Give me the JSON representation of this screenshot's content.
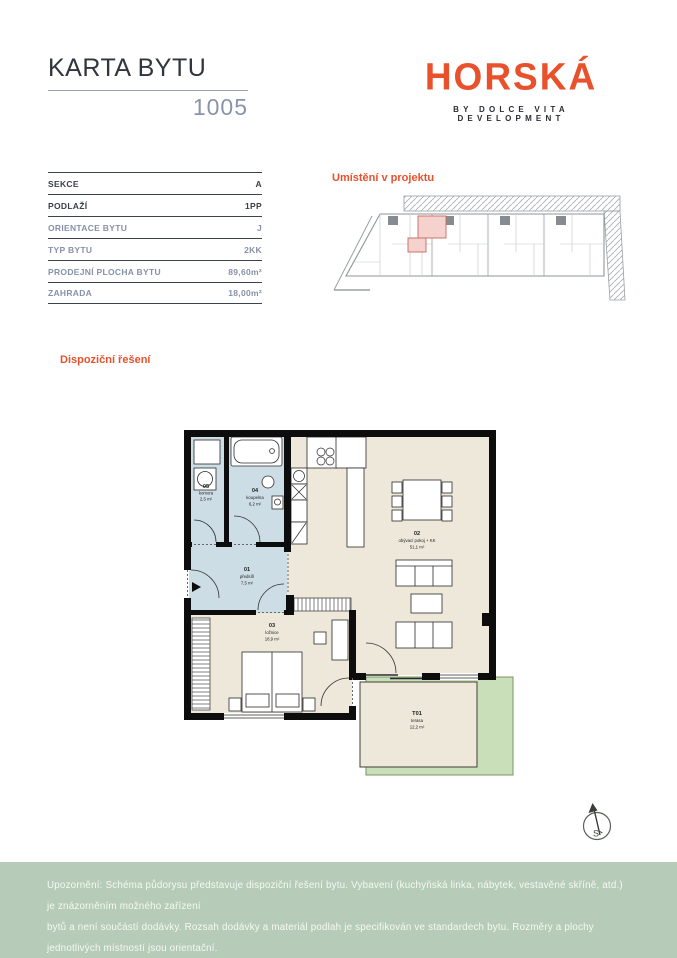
{
  "page": {
    "title": "KARTA BYTU",
    "unit_number": "1005"
  },
  "brand": {
    "logo_text": "HORSKÁ",
    "tagline": "BY DOLCE VITA DEVELOPMENT",
    "accent_color": "#e8512c"
  },
  "details_table": {
    "rows": [
      {
        "label": "SEKCE",
        "value": "A"
      },
      {
        "label": "PODLAŽÍ",
        "value": "1PP"
      },
      {
        "label": "ORIENTACE BYTU",
        "value": "J"
      },
      {
        "label": "TYP BYTU",
        "value": "2KK"
      },
      {
        "label": "PRODEJNÍ PLOCHA BYTU",
        "value": "89,60m²"
      },
      {
        "label": "ZAHRADA",
        "value": "18,00m²"
      }
    ]
  },
  "sections": {
    "location_heading": "Umístění v projektu",
    "layout_heading": "Dispoziční řešení"
  },
  "floor_plan": {
    "rooms": [
      {
        "id": "01",
        "name": "předsíň",
        "area": "7,5 m²"
      },
      {
        "id": "02",
        "name": "obývací pokoj + KK",
        "area": "51,1 m²"
      },
      {
        "id": "03",
        "name": "ložnice",
        "area": "18,9 m²"
      },
      {
        "id": "04",
        "name": "koupelna",
        "area": "6,2 m²"
      },
      {
        "id": "05",
        "name": "komora",
        "area": "2,5 m²"
      },
      {
        "id": "T01",
        "name": "terasa",
        "area": "12,2 m²"
      }
    ],
    "colors": {
      "room_blue": "#cddde6",
      "room_beige": "#ede8da",
      "garden_green": "#c8dfb9",
      "highlight_pink": "#f6d2ce"
    }
  },
  "compass": {
    "north_label": "S"
  },
  "footer": {
    "disclaimer_lines": [
      "Upozornění: Schéma půdorysu představuje dispoziční řešení bytu. Vybavení (kuchyňská linka, nábytek, vestavěné skříně, atd.) je znázorněním možného zařízení",
      "bytů a není součástí dodávky. Rozsah dodávky a materiál podlah je specifikován ve standardech bytu. Rozměry a plochy jednotlivých místností jsou orientační.",
      "Investor si vyhrazuje právo na změnu. Podlahová plocha bytu je vypočtena dle platných právních předpisů (nařízení vlády č. 366/2013 Sb.)."
    ]
  }
}
